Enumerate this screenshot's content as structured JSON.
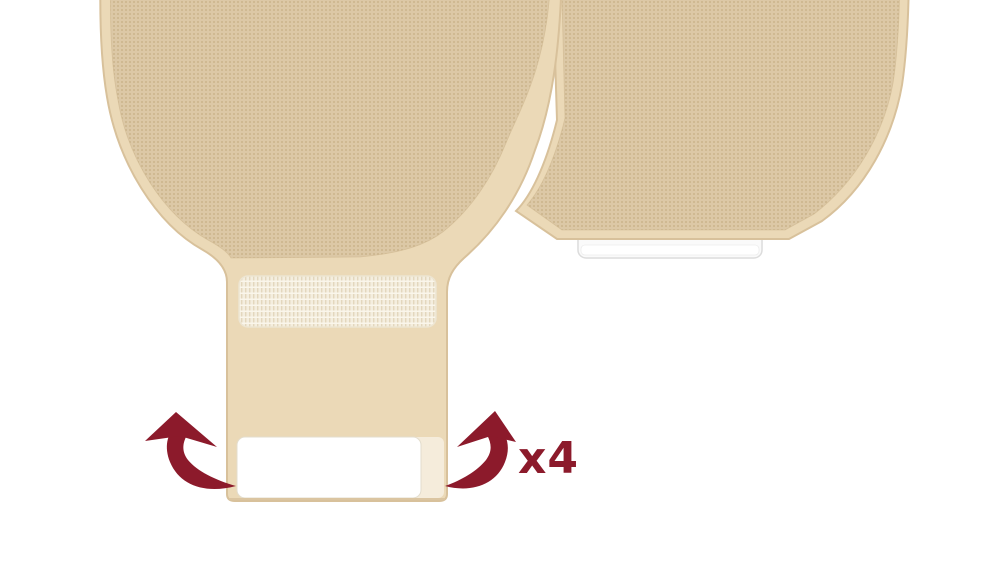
{
  "figure": {
    "type": "instructional-illustration",
    "subject": "Drainable ostomy pouch: roll the outlet sleeve upward four times to close; a closed pouch is shown behind",
    "repeat_annotation": "x4"
  },
  "colors": {
    "background": "#FFFFFF",
    "pouch_film_border": "#EBD9B7",
    "pouch_fabric_base": "#DCC8A6",
    "pouch_fabric_dot": "#C8B089",
    "pouch_outline": "#D8C19B",
    "texture_edge": "#CDB58D",
    "velcro_base": "#F4EEDF",
    "velcro_rib": "#E3D7BD",
    "velcro_highlight": "#FAF6EB",
    "velcro_border": "#EDE5D2",
    "outlet_white": "#FFFFFF",
    "outlet_white_border": "#E3DDCD",
    "outlet_cream": "#F5ECDB",
    "sleeve_bottom_line": "#DBC5A1",
    "tab_white": "#FAFAFA",
    "tab_border": "#DCDCDC",
    "arrow_maroon": "#8C1A2B"
  }
}
